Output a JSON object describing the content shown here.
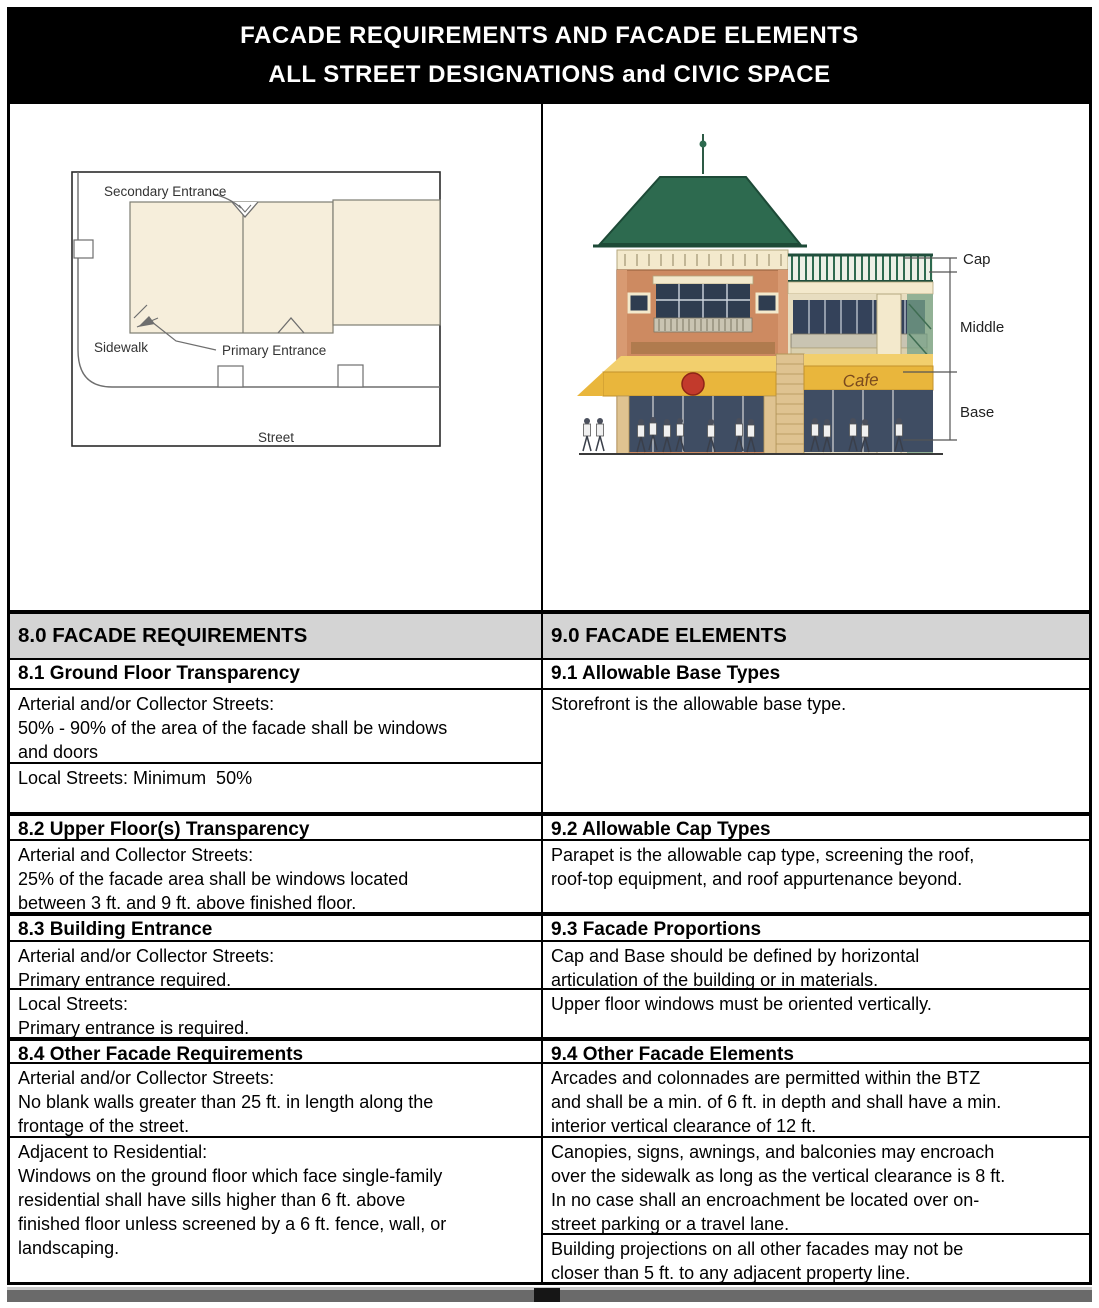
{
  "header": {
    "title_line1": "FACADE REQUIREMENTS AND FACADE ELEMENTS",
    "title_line2": "ALL STREET DESIGNATIONS and CIVIC SPACE"
  },
  "site_plan": {
    "labels": {
      "secondary_entrance": "Secondary Entrance",
      "sidewalk": "Sidewalk",
      "primary_entrance": "Primary Entrance",
      "street": "Street"
    }
  },
  "facade_sketch": {
    "labels": {
      "cap": "Cap",
      "middle": "Middle",
      "base": "Base",
      "cafe": "Cafe"
    }
  },
  "table": {
    "left": {
      "rows": [
        {
          "kind": "section",
          "text": "8.0 FACADE REQUIREMENTS"
        },
        {
          "kind": "heading",
          "text": "8.1 Ground Floor Transparency"
        },
        {
          "kind": "content",
          "text": "Arterial and/or Collector Streets:\n50% - 90% of the area of the facade shall be windows\nand doors"
        },
        {
          "kind": "content",
          "text": "Local Streets: Minimum  50%"
        },
        {
          "kind": "heading",
          "text": "8.2 Upper Floor(s) Transparency"
        },
        {
          "kind": "content",
          "text": "Arterial and Collector Streets:\n25% of the facade area shall be windows located\nbetween 3 ft. and 9 ft. above finished floor."
        },
        {
          "kind": "heading",
          "text": "8.3 Building Entrance"
        },
        {
          "kind": "content",
          "text": "Arterial and/or Collector Streets:\nPrimary entrance required."
        },
        {
          "kind": "content",
          "text": "Local Streets:\nPrimary entrance is required."
        },
        {
          "kind": "heading",
          "text": "8.4 Other Facade Requirements"
        },
        {
          "kind": "content",
          "text": "Arterial and/or Collector Streets:\nNo blank walls greater than 25 ft. in length along the\nfrontage of the street."
        },
        {
          "kind": "content",
          "text": "Adjacent to Residential:\nWindows on the ground floor which face single-family\nresidential shall have sills higher than 6 ft. above\nfinished floor unless screened by a 6 ft. fence, wall, or\nlandscaping."
        }
      ]
    },
    "right": {
      "rows": [
        {
          "kind": "section",
          "text": "9.0 FACADE ELEMENTS"
        },
        {
          "kind": "heading",
          "text": "9.1 Allowable Base Types"
        },
        {
          "kind": "content",
          "text": "Storefront is the allowable base type."
        },
        {
          "kind": "heading",
          "text": "9.2 Allowable Cap Types"
        },
        {
          "kind": "content",
          "text": "Parapet is the allowable cap type, screening the roof,\nroof-top equipment, and roof appurtenance beyond."
        },
        {
          "kind": "heading",
          "text": "9.3 Facade Proportions"
        },
        {
          "kind": "content",
          "text": "Cap and Base should be defined by horizontal\narticulation of the building or in materials."
        },
        {
          "kind": "content",
          "text": "Upper floor windows must be oriented vertically."
        },
        {
          "kind": "heading",
          "text": "9.4 Other Facade Elements"
        },
        {
          "kind": "content",
          "text": "Arcades and colonnades are permitted within the BTZ\nand shall be a min. of 6 ft. in depth and shall have a min.\ninterior vertical clearance of 12 ft."
        },
        {
          "kind": "content",
          "text": "Canopies, signs, awnings, and balconies may encroach\nover the sidewalk as long as the vertical clearance is 8 ft.\nIn no case shall an encroachment be located over on-\nstreet parking or a travel lane."
        },
        {
          "kind": "content",
          "text": "Building projections on all other facades may not be\ncloser than 5 ft. to any adjacent property line."
        }
      ]
    }
  },
  "colors": {
    "header_bg": "#000000",
    "header_text": "#ffffff",
    "section_header_bg": "#d4d4d4",
    "table_border": "#000000",
    "plan_building_fill": "#f6eedb",
    "roof_green": "#2d6a4f",
    "brick": "#cd8a61",
    "trim_cream": "#f3e9cc",
    "awning_yellow": "#e9b63c",
    "logo_red": "#c23a2c",
    "window_dark": "#2f3d50",
    "bottom_bar_gray": "#6a6a6a"
  }
}
